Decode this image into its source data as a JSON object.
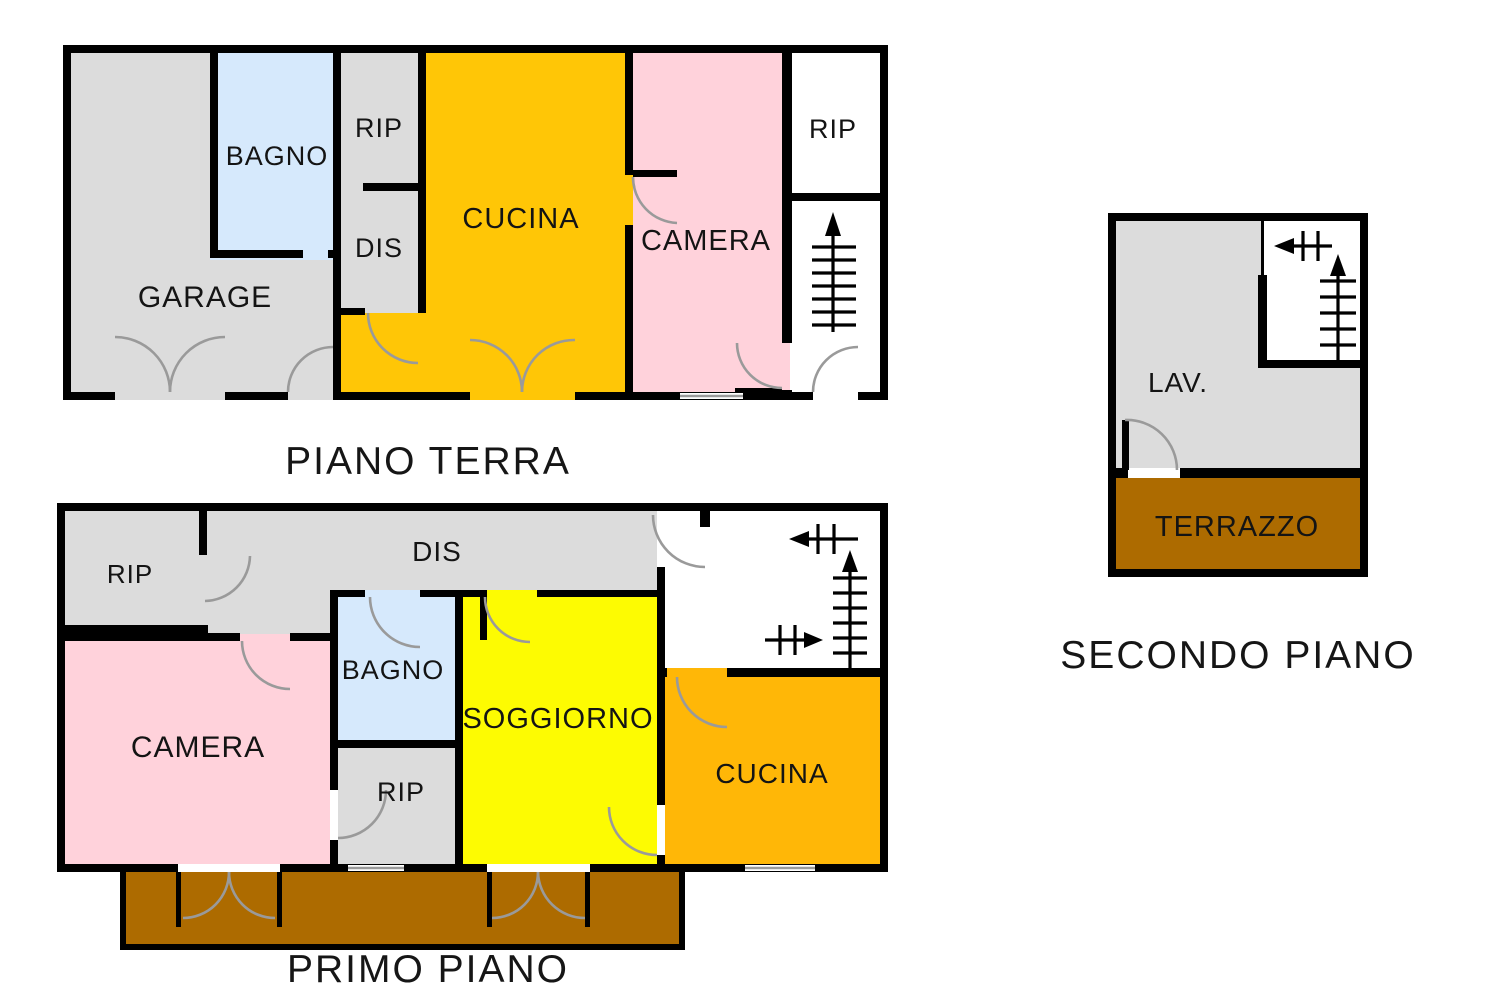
{
  "document": {
    "type": "floor-plan",
    "language": "it"
  },
  "floors": {
    "ground": {
      "title": "PIANO TERRA",
      "rooms": {
        "garage": "GARAGE",
        "bagno": "BAGNO",
        "rip": "RIP",
        "dis": "DIS",
        "cucina": "CUCINA",
        "camera": "CAMERA",
        "rip2": "RIP"
      }
    },
    "first": {
      "title": "PRIMO PIANO",
      "rooms": {
        "rip": "RIP",
        "dis": "DIS",
        "camera": "CAMERA",
        "bagno": "BAGNO",
        "rip2": "RIP",
        "soggiorno": "SOGGIORNO",
        "cucina": "CUCINA"
      }
    },
    "second": {
      "title": "SECONDO PIANO",
      "rooms": {
        "lav": "LAV.",
        "terrazzo": "TERRAZZO"
      }
    }
  },
  "colors": {
    "wall": "#000000",
    "room_gray": "#dcdcdc",
    "bathroom_blue": "#d6e9fc",
    "bedroom_pink": "#ffd2db",
    "kitchen_gold": "#ffc606",
    "kitchen_orange": "#ffb707",
    "living_yellow": "#fdfb02",
    "terrace_brown": "#ad6b00",
    "stairwell_white": "#ffffff",
    "door_arc_gray": "#9a9a9a",
    "terrace_label_brown": "#402600"
  }
}
